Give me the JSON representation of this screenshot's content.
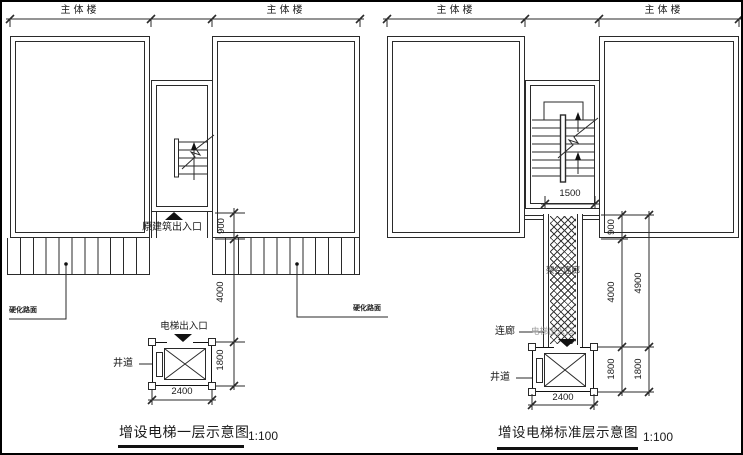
{
  "left_plan": {
    "building_label_left": "主体楼",
    "building_label_right": "主体楼",
    "original_entrance_label": "原建筑出入口",
    "pavement_label_left": "硬化路面",
    "pavement_label_right": "硬化路面",
    "elevator_entrance_label": "电梯出入口",
    "shaft_label": "井道",
    "dim_entrance_depth": "900",
    "dim_forecourt_length": "4000",
    "dim_shaft_depth": "1800",
    "dim_shaft_width": "2400",
    "title": "增设电梯一层示意图",
    "scale": "1:100"
  },
  "right_plan": {
    "building_label_left": "主体楼",
    "building_label_right": "主体楼",
    "dim_stair_width": "1500",
    "corridor_hatch_label": "架空连廊",
    "corridor_label": "连廊",
    "elevator_entrance_label": "电梯出入口",
    "shaft_label": "井道",
    "dim_entrance_depth": "900",
    "dim_corridor_length": "4000",
    "dim_total_length": "4900",
    "dim_shaft_depth": "1800",
    "dim_shaft_depth_outer": "1800",
    "dim_shaft_width": "2400",
    "title": "增设电梯标准层示意图",
    "scale": "1:100"
  }
}
